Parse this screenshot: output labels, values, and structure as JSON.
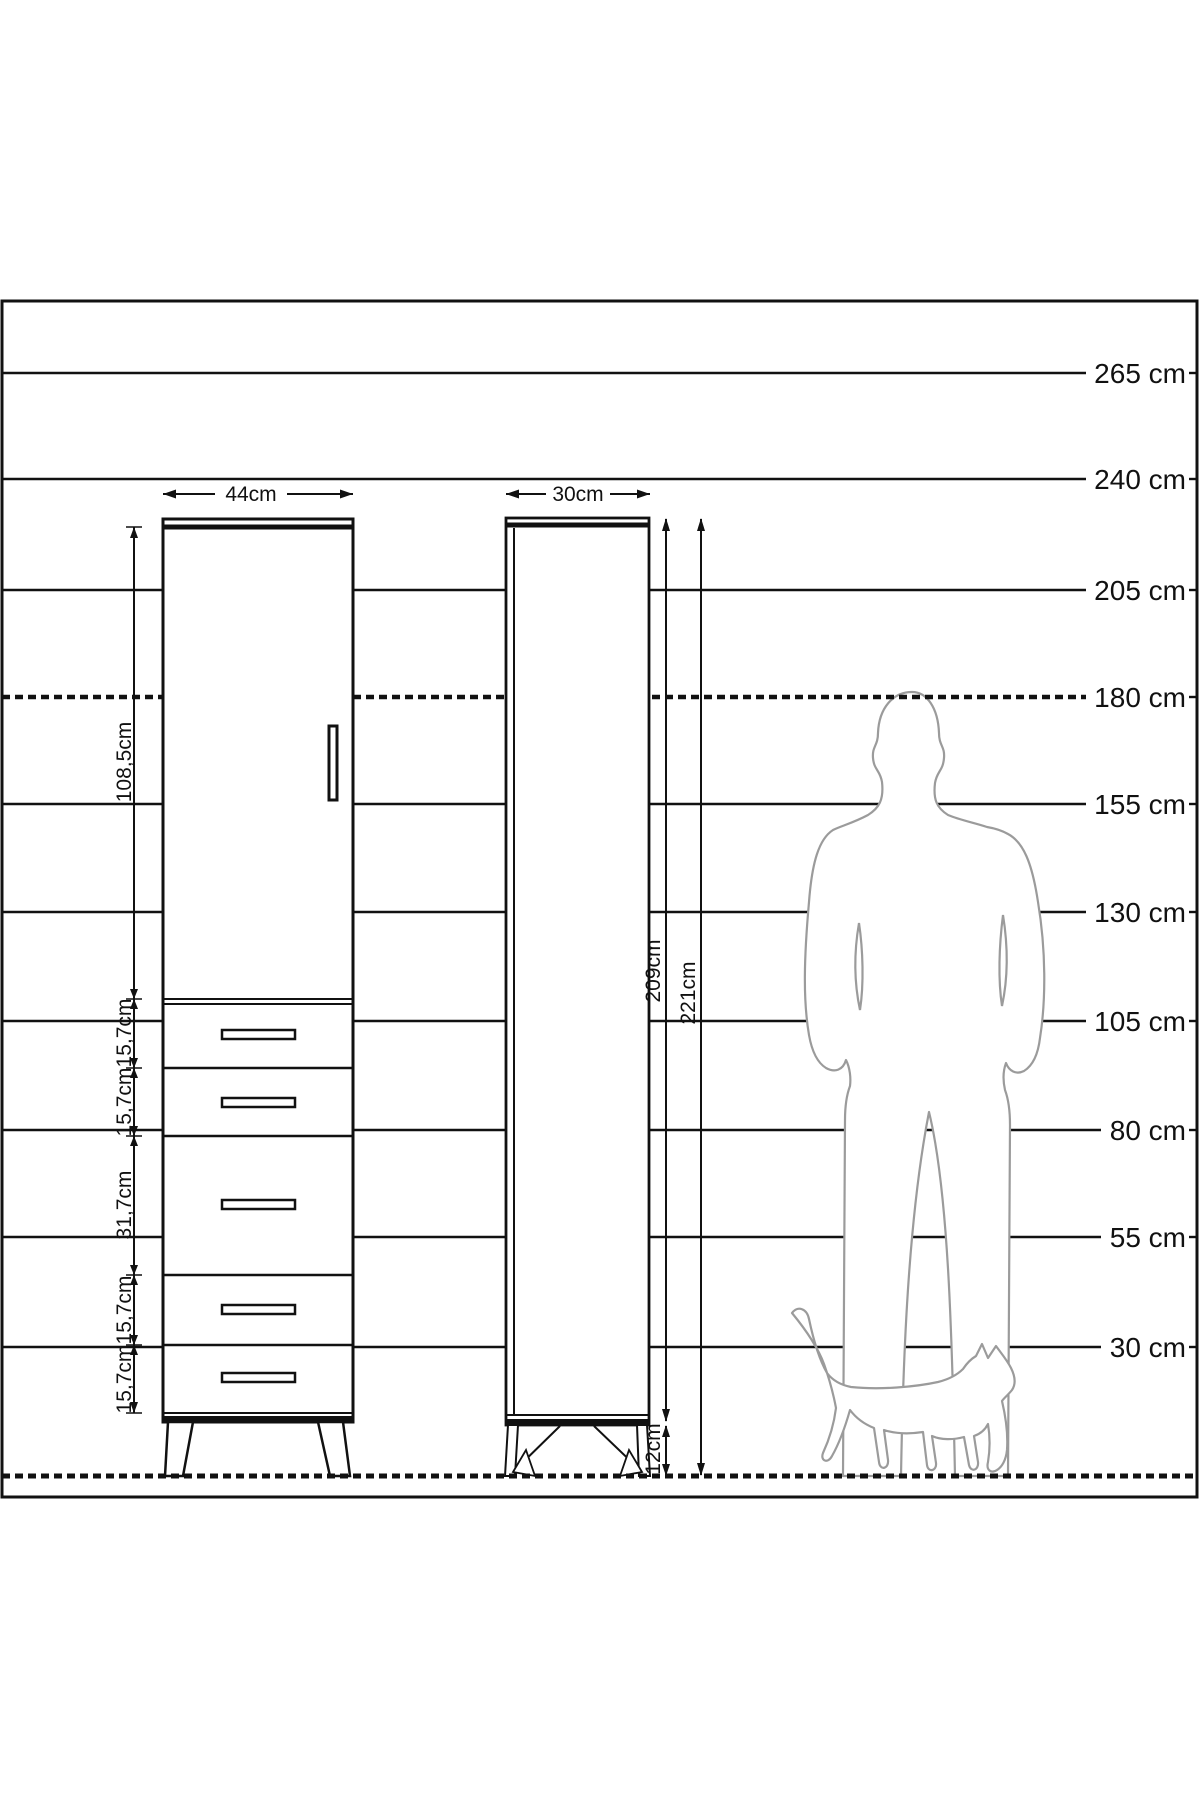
{
  "scale": {
    "labels": [
      "265 cm",
      "240 cm",
      "205 cm",
      "180 cm",
      "155 cm",
      "130 cm",
      "105 cm",
      "80 cm",
      "55 cm",
      "30 cm"
    ]
  },
  "front_view": {
    "width_label": "44cm",
    "door_height_label": "108,5cm",
    "drawer_height_labels": [
      "15,7cm",
      "15,7cm",
      "31,7cm",
      "15,7cm",
      "15,7cm"
    ]
  },
  "side_view": {
    "depth_label": "30cm",
    "carcass_height_label": "209cm",
    "total_height_label": "221cm",
    "leg_height_label": "12cm"
  }
}
